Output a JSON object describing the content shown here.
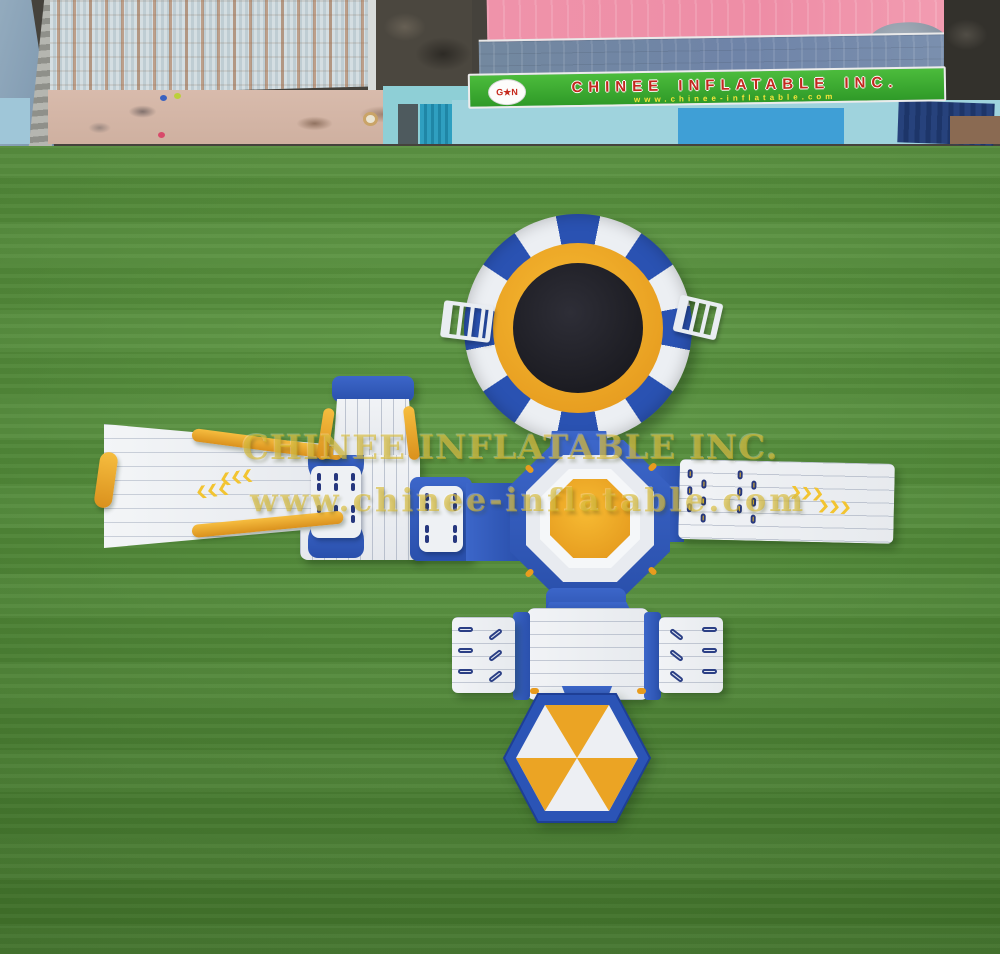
{
  "scene": {
    "description": "Aerial top-down product photo of a blue, white and yellow inflatable floating water park laid out on a green artificial lawn in a factory yard",
    "setting": "factory yard: rusty corrugated roof, pink and blue shed roofs, light-blue walls, concrete courtyard",
    "product_parts": [
      "round water trampoline with black jump mat and two boarding ladders",
      "octagonal center platform with yellow octagon top",
      "wide flared slide with orange side rails and left-pointing chevrons",
      "lace-up climbing walkway modules with yellow grommets",
      "tower ramp with blue cap",
      "long right walkway with grommets and right-pointing chevrons",
      "lower square platform with two winged side decks and grip slots",
      "hexagonal beach-ball pad with alternating yellow and white panels"
    ]
  },
  "banner": {
    "title": "CHINEE INFLATABLE INC.",
    "url": "www.chinee-inflatable.com",
    "logo_text": "G★N"
  },
  "watermark": {
    "line1": "CHINEE INFLATABLE INC.",
    "line2": "www.chinee-inflatable.com"
  },
  "colors": {
    "inflatable_blue": "#2b54b4",
    "inflatable_white": "#edf0f4",
    "accent_yellow": "#f0ab24",
    "trampoline_mat": "#1f1f26",
    "grass_green": "#4f9134",
    "banner_green": "#3db232",
    "banner_text_red": "#c2281e",
    "banner_url_yellow": "#f4e43b",
    "roof_pink": "#ee8da6",
    "roof_blue_gray": "#7186aa"
  }
}
